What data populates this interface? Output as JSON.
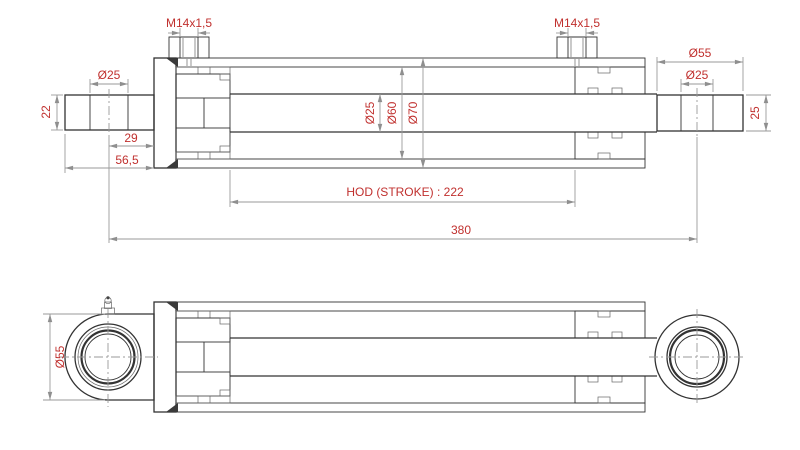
{
  "colors": {
    "dimension_text": "#c0302e",
    "drawing_line": "#333333",
    "dimension_line": "#9a9a9a",
    "background": "#ffffff"
  },
  "top_view": {
    "dims": {
      "port_left": "M14x1,5",
      "port_right": "M14x1,5",
      "eye_left_bore": "Ø25",
      "eye_left_width": "22",
      "hole_center_to_face": "29",
      "eye_to_face": "56,5",
      "rod_diameter": "Ø25",
      "bore_diameter": "Ø60",
      "barrel_outer_diameter": "Ø70",
      "stroke": "HOD (STROKE) : 222",
      "overall_length": "380",
      "eye_right_outer": "Ø55",
      "eye_right_bore": "Ø25",
      "eye_right_width": "25"
    }
  },
  "bottom_view": {
    "dims": {
      "eye_outer_diameter": "Ø55"
    }
  }
}
